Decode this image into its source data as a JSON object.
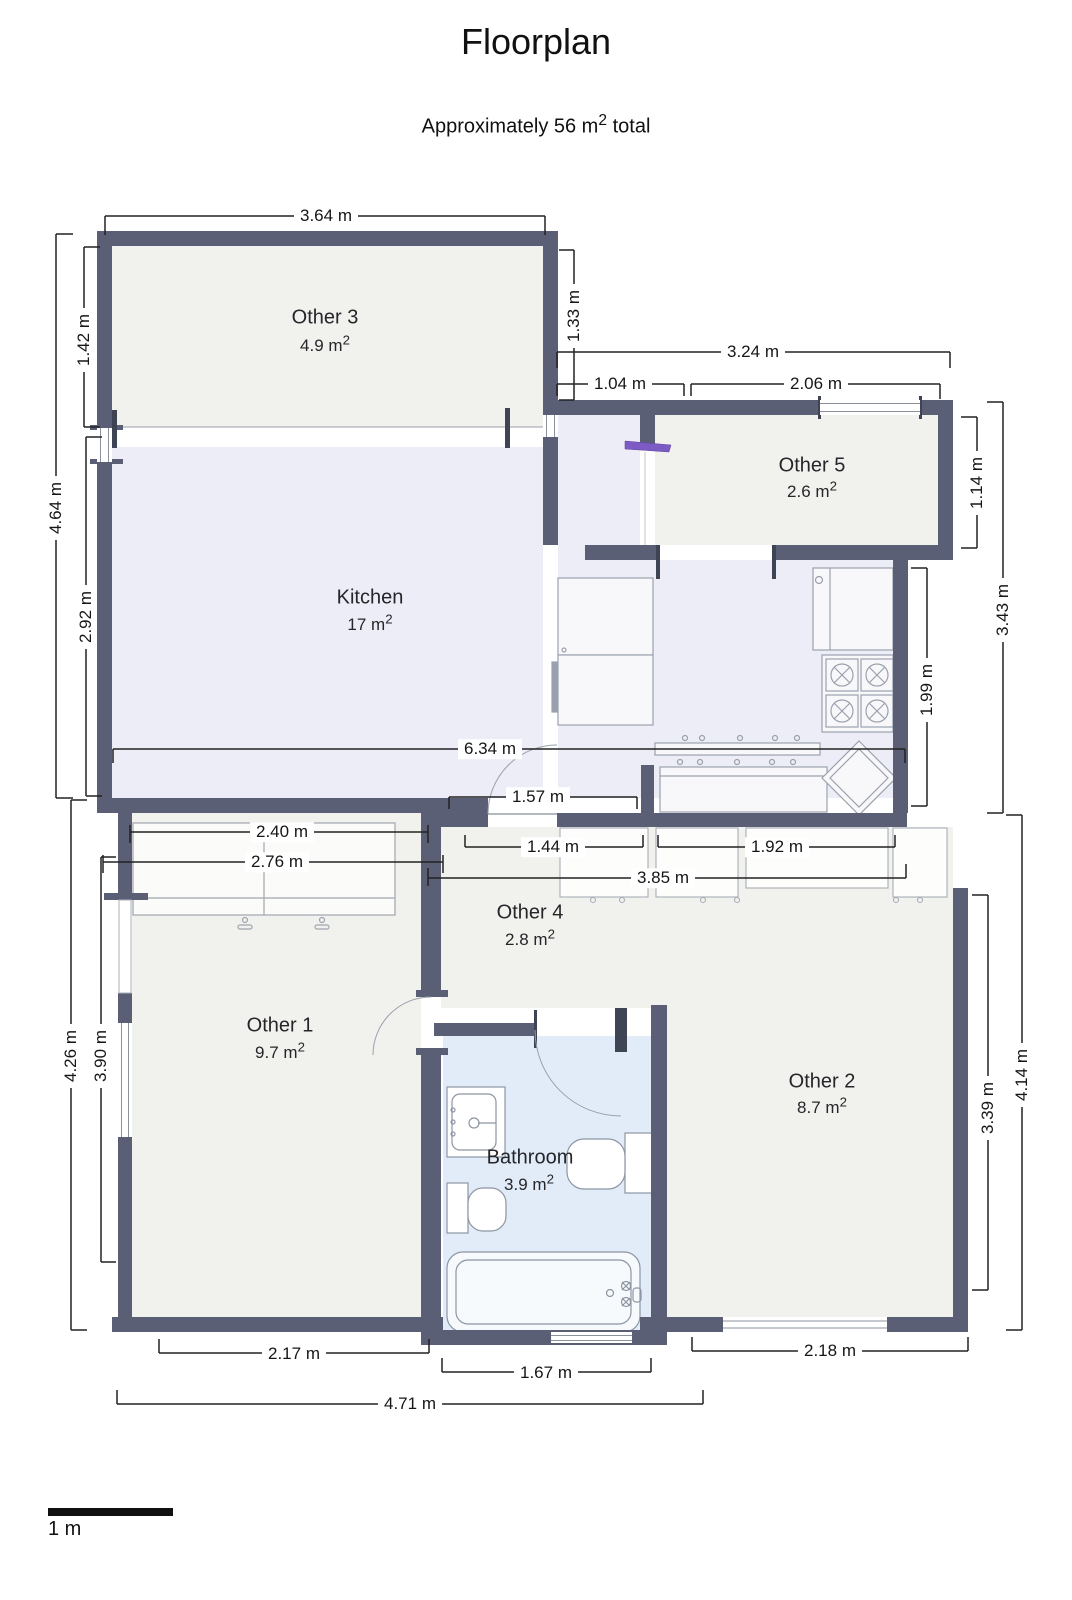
{
  "title": "Floorplan",
  "subtitle": {
    "prefix": "Approximately 56 m",
    "sup": "2",
    "suffix": " total"
  },
  "rooms": {
    "other3": {
      "name": "Other 3",
      "area": "4.9 m",
      "sup": "2"
    },
    "kitchen": {
      "name": "Kitchen",
      "area": "17 m",
      "sup": "2"
    },
    "other5": {
      "name": "Other 5",
      "area": "2.6 m",
      "sup": "2"
    },
    "other4": {
      "name": "Other 4",
      "area": "2.8 m",
      "sup": "2"
    },
    "other1": {
      "name": "Other 1",
      "area": "9.7 m",
      "sup": "2"
    },
    "other2": {
      "name": "Other 2",
      "area": "8.7 m",
      "sup": "2"
    },
    "bathroom": {
      "name": "Bathroom",
      "area": "3.9 m",
      "sup": "2"
    }
  },
  "dimensions": {
    "other3_width": "3.64 m",
    "upper_right_width": "3.24 m",
    "seg_1_04": "1.04 m",
    "seg_2_06": "2.06 m",
    "kitchen_width": "6.34 m",
    "seg_1_57": "1.57 m",
    "wardrobe_width": "2.40 m",
    "other1_top_width": "2.76 m",
    "seg_1_44": "1.44 m",
    "seg_1_92": "1.92 m",
    "corridor_width": "3.85 m",
    "other1_bottom": "2.17 m",
    "bathroom_bottom": "1.67 m",
    "other2_bottom": "2.18 m",
    "total_bottom": "4.71 m",
    "left_total": "4.64 m",
    "other3_height": "1.42 m",
    "kitchen_height": "2.92 m",
    "other3_right_height": "1.33 m",
    "other5_height": "1.14 m",
    "right_upper_total": "3.43 m",
    "kitchen_right_height": "1.99 m",
    "other1_height": "3.90 m",
    "left_lower_total": "4.26 m",
    "other2_height": "3.39 m",
    "right_lower_total": "4.14 m"
  },
  "scale_bar": {
    "label": "1 m"
  },
  "colors": {
    "wall": "#5a5f76",
    "room_fill": "#f1f1ee",
    "kitchen_fill": "#ecedf6",
    "bathroom_fill": "#e2ecf8",
    "door_accent": "#7c5cc4",
    "dimension_line": "#222222"
  }
}
